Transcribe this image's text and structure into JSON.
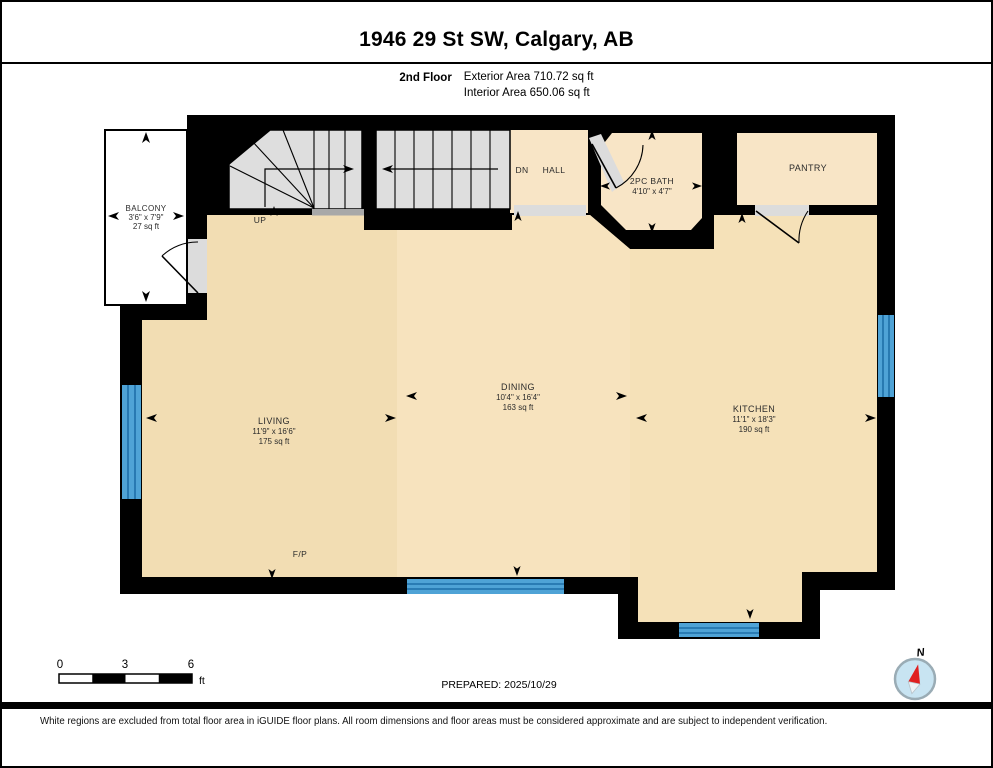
{
  "header": {
    "title": "1946 29 St SW, Calgary, AB",
    "floor_label": "2nd Floor",
    "exterior_area": "Exterior Area 710.72 sq ft",
    "interior_area": "Interior Area 650.06 sq ft"
  },
  "rooms": {
    "balcony": {
      "name": "BALCONY",
      "dims": "3'6\" x 7'9\"",
      "area": "27 sq ft"
    },
    "living": {
      "name": "LIVING",
      "dims": "11'9\" x 16'6\"",
      "area": "175 sq ft"
    },
    "dining": {
      "name": "DINING",
      "dims": "10'4\" x 16'4\"",
      "area": "163 sq ft"
    },
    "kitchen": {
      "name": "KITCHEN",
      "dims": "11'1\" x 18'3\"",
      "area": "190 sq ft"
    },
    "bath": {
      "name": "2PC BATH",
      "dims": "4'10\" x 4'7\""
    },
    "pantry": {
      "name": "PANTRY"
    },
    "hall": {
      "name": "HALL"
    }
  },
  "annotations": {
    "up": "UP",
    "down": "DN",
    "fireplace": "F/P"
  },
  "scale_bar": {
    "ticks": [
      "0",
      "3",
      "6"
    ],
    "unit": "ft"
  },
  "footer": {
    "prepared": "PREPARED: 2025/10/29",
    "disclaimer": "White regions are excluded from total floor area in iGUIDE floor plans. All room dimensions and floor areas must be considered approximate and are subject to independent verification."
  },
  "compass": {
    "north_label": "N"
  },
  "colors": {
    "wall": "#000000",
    "floor_living": "#f2ddb3",
    "floor_dining": "#f7e3be",
    "floor_kitchen": "#f5e1b8",
    "floor_rooms": "#f8e5c6",
    "stairs": "#dedede",
    "landing": "#a8a8a8",
    "opening": "#dcdcdc",
    "window_blue": "#4fa3d6",
    "window_stripe": "#1f6fa8",
    "compass_needle": "#e02020",
    "compass_fill": "#c8e4f2"
  }
}
